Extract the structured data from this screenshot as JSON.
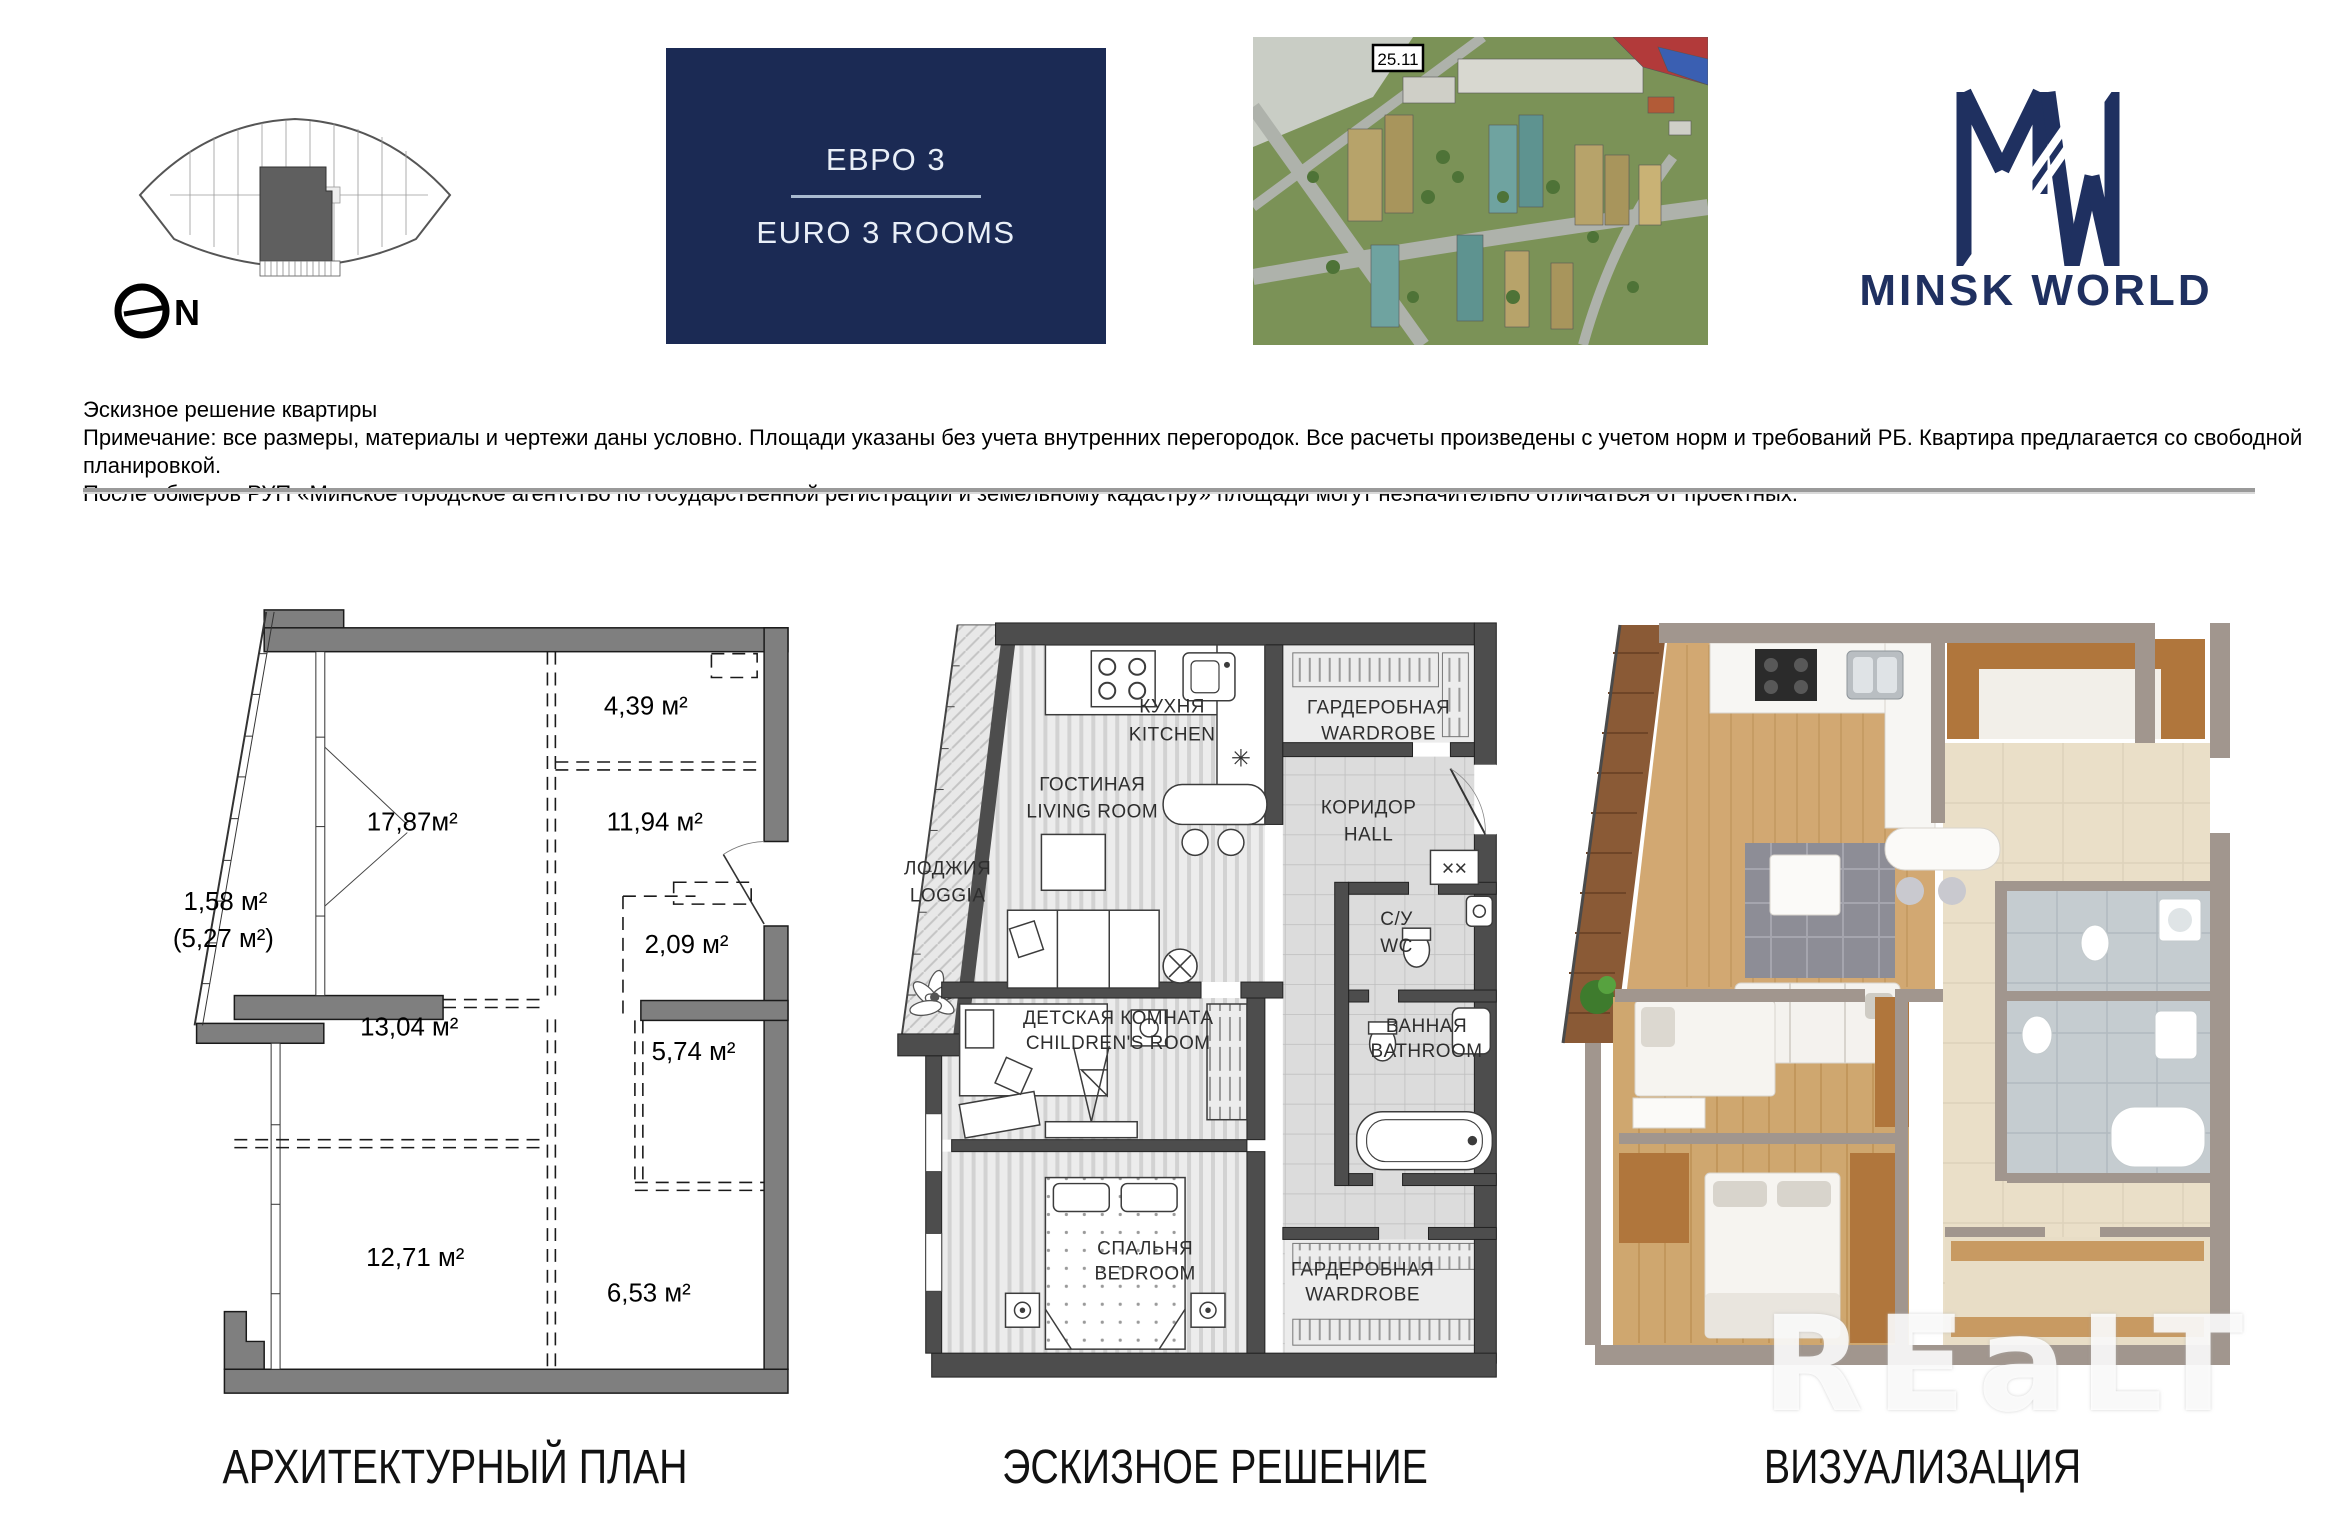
{
  "header": {
    "floorplate": {
      "north_label": "N"
    },
    "badge": {
      "title_ru": "ЕВРО 3",
      "title_en": "EURO 3 ROOMS"
    },
    "aerial": {
      "building_label": "25.11"
    },
    "logo": {
      "brand": "MINSK WORLD"
    }
  },
  "notes": {
    "line1": "Эскизное решение квартиры",
    "line2": "Примечание: все размеры, материалы и чертежи даны условно. Площади указаны без учета внутренних перегородок. Все расчеты произведены с учетом норм и требований РБ. Квартира предлагается со свободной планировкой.",
    "line3": "После обмеров РУП «Минское городское агентство по государственной регистрации и земельному кадастру» площади могут незначительно отличаться от проектных."
  },
  "architectural": {
    "caption": "АРХИТЕКТУРНЫЙ ПЛАН",
    "areas": {
      "a439": "4,39 м²",
      "a1787": "17,87м²",
      "a1194": "11,94 м²",
      "a209": "2,09 м²",
      "a158": "1,58 м²",
      "a527": "(5,27 м²)",
      "a1304": "13,04 м²",
      "a574": "5,74 м²",
      "a1271": "12,71 м²",
      "a653": "6,53 м²"
    }
  },
  "sketch": {
    "caption": "ЭСКИЗНОЕ РЕШЕНИЕ",
    "rooms": {
      "kitchen": {
        "ru": "КУХНЯ",
        "en": "KITCHEN"
      },
      "wardrobe_top": {
        "ru": "ГАРДЕРОБНАЯ",
        "en": "WARDROBE"
      },
      "living": {
        "ru": "ГОСТИНАЯ",
        "en": "LIVING ROOM"
      },
      "hall": {
        "ru": "КОРИДОР",
        "en": "HALL"
      },
      "loggia": {
        "ru": "ЛОДЖИЯ",
        "en": "LOGGIA"
      },
      "wc": {
        "ru": "С/У",
        "en": "WC"
      },
      "children": {
        "ru": "ДЕТСКАЯ КОМНАТА",
        "en": "CHILDREN'S ROOM"
      },
      "bathroom": {
        "ru": "ВАННАЯ",
        "en": "BATHROOM"
      },
      "bedroom": {
        "ru": "СПАЛЬНЯ",
        "en": "BEDROOM"
      },
      "wardrobe_bottom": {
        "ru": "ГАРДЕРОБНАЯ",
        "en": "WARDROBE"
      }
    },
    "symbols": {
      "door_mark": "××",
      "vent": "✳"
    }
  },
  "visualization": {
    "caption": "ВИЗУАЛИЗАЦИЯ",
    "watermark": "REaLT"
  },
  "colors": {
    "navy": "#1b2a54",
    "logo_navy": "#1f3060",
    "wall_gray": "#7f7f7f",
    "wall_dark": "#4d4d4d",
    "wood": "#d2a872",
    "hall_tile": "#eadfc8"
  }
}
